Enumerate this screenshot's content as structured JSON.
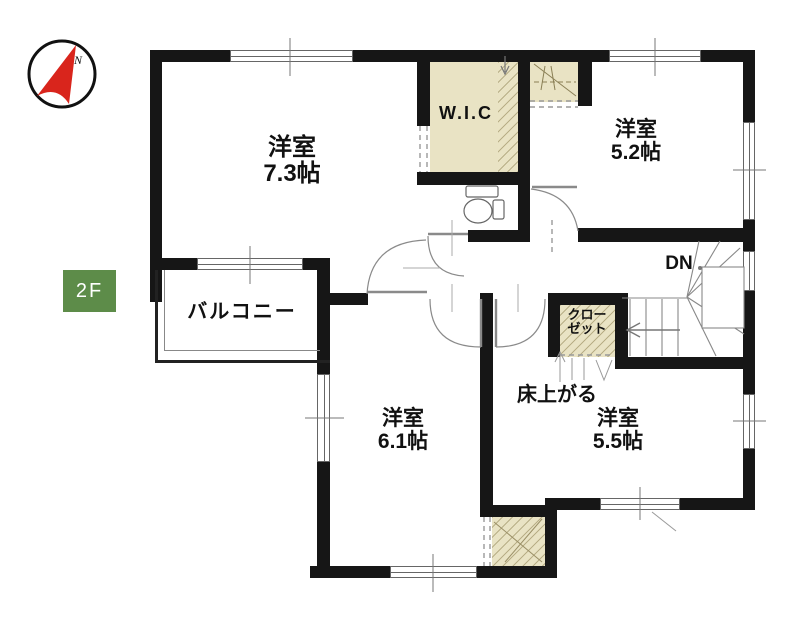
{
  "floor": {
    "badge": "2F"
  },
  "compass": {
    "north_label": "N"
  },
  "rooms": {
    "bedroom73": {
      "name": "洋室",
      "size": "7.3帖"
    },
    "wic": {
      "name": "W.I.C"
    },
    "bedroom52": {
      "name": "洋室",
      "size": "5.2帖"
    },
    "balcony": {
      "name": "バルコニー"
    },
    "stair_closet": {
      "name_line1": "クロー",
      "name_line2": "ゼット"
    },
    "bedroom61": {
      "name": "洋室",
      "size": "6.1帖"
    },
    "bedroom55": {
      "name": "洋室",
      "size": "5.5帖"
    }
  },
  "annotations": {
    "stairs_down": "DN",
    "floor_step": "床上がる"
  },
  "colors": {
    "wall": "#161616",
    "closet_fill": "#e9e3c4",
    "floor_badge_bg": "#5d8c49",
    "compass_red": "#d9251c"
  }
}
